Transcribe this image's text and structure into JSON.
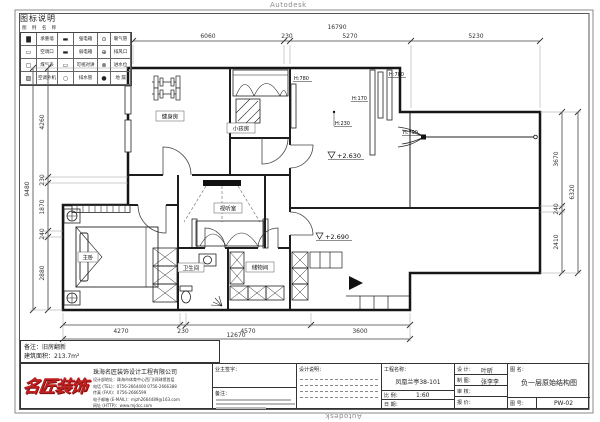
{
  "watermark": {
    "top": "Autodesk",
    "bottom": "Autodesk"
  },
  "legend": {
    "title": "图标说明",
    "subtitle": "图 例  名 称",
    "rows": [
      [
        "▇",
        "承重墙",
        "▬",
        "强电箱",
        "⊙",
        "暖气管"
      ],
      [
        "▭",
        "空调口",
        "▬",
        "弱电箱",
        "⊕",
        "排风口"
      ],
      [
        "▢",
        "煤气表",
        "▭",
        "可视对讲",
        "⊗",
        "进水位"
      ],
      [
        "▨",
        "空调外机",
        "○",
        "排水管",
        "●",
        "地 漏"
      ]
    ]
  },
  "dims": {
    "top": {
      "overall": "16790",
      "segments": [
        "6060",
        "230",
        "5270",
        "5230"
      ]
    },
    "left": {
      "overall": "9480",
      "segments": [
        "4260",
        "230",
        "1870",
        "240",
        "2880"
      ]
    },
    "right": {
      "overall": "6320",
      "segments": [
        "3670",
        "240",
        "2410"
      ]
    },
    "bottom": {
      "overall": "12670",
      "segments": [
        "4270",
        "230",
        "4570",
        "3600"
      ]
    }
  },
  "plan": {
    "rooms": {
      "gym": "健身房",
      "kids": "小孩房",
      "av": "视听室",
      "master": "主卧",
      "bath": "卫生间",
      "storage": "储物间"
    },
    "levels": {
      "upper": "+2.630",
      "lower": "+2.690"
    },
    "callouts": {
      "h780a": "H:780",
      "h170": "H:170",
      "h780b": "H:780",
      "h230": "H:230",
      "h790": "H:790"
    }
  },
  "notes": {
    "remark": "备注：旧房翻新",
    "area": "建筑面积：213.7m²"
  },
  "company": {
    "logo_text": "名匠装饰",
    "name": "珠海名匠装饰设计工程有限公司",
    "address": "设计部地址：珠海市体育中心西门(网球馆首层",
    "tel": "电话 (TEL)：0756-2664400  0756-2666388",
    "fax": "传真 (FAX)：0756-2666599",
    "email": "电子邮箱 (E-MAIL)：mjzh2664489@163.com",
    "web": "网址 (HTTP)：www.mjdcc.com"
  },
  "titleblock": {
    "owner_sign_label": "业主签字：",
    "remark_label": "备注：",
    "design_note_label": "设计说明：",
    "project_label": "工程名称：",
    "project_value": "凤凰兰亭38-101",
    "scale_label": "比 例：",
    "scale_value": "1:60",
    "date_label": "日 期：",
    "designer_label": "设 计：",
    "designer_value": "叶昕",
    "drafter_label": "制 图：",
    "drafter_value": "张李李",
    "checker_label": "审 核：",
    "price_label": "报 价：",
    "name_label": "图 名：",
    "drawing_name": "负一层原始结构图",
    "no_label": "图 号：",
    "drawing_no": "PW-02"
  }
}
